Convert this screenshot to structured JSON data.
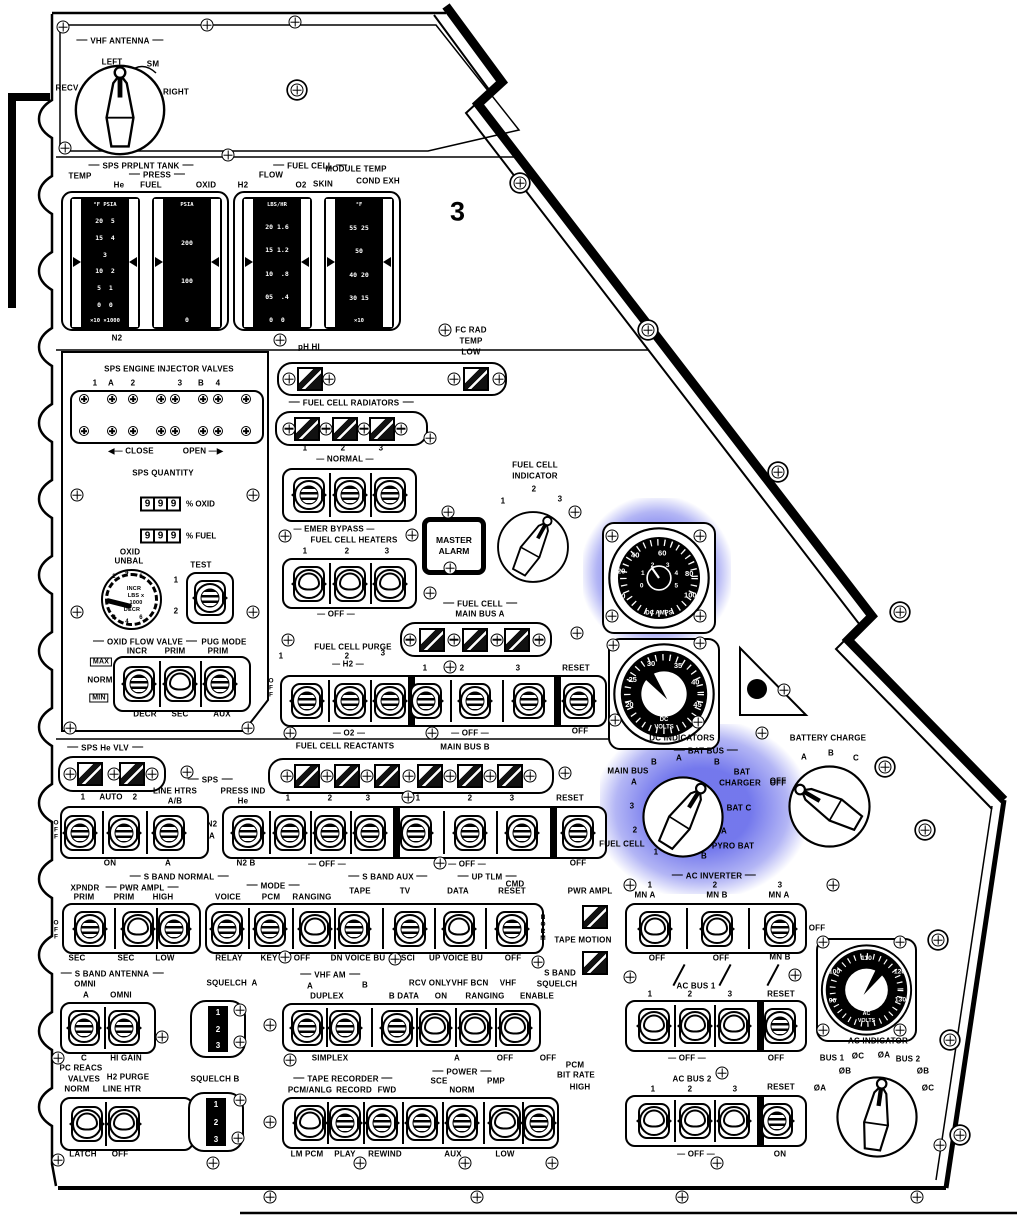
{
  "colors": {
    "highlight": "#686deb",
    "ink": "#000000",
    "paper": "#ffffff"
  },
  "panel": {
    "number": "3"
  },
  "vhf": {
    "title": "VHF ANTENNA",
    "recv": "RECV",
    "left": "LEFT",
    "sm": "SM",
    "right": "RIGHT"
  },
  "tanks": {
    "sps": "SPS PRPLNT TANK",
    "temp": "TEMP",
    "press": "PRESS",
    "he": "He",
    "fuel": "FUEL",
    "oxid": "OXID",
    "fc": "FUEL CELL",
    "flow": "FLOW",
    "h2": "H2",
    "o2": "O2",
    "module": "MODULE TEMP",
    "skin": "SKIN",
    "cond": "COND EXH",
    "n2": "N2",
    "g1h": "°F PSIA",
    "g1": [
      "20  5",
      "15  4",
      "3",
      "10  2",
      "5  1",
      "0  0"
    ],
    "g1f": "×10 ×1000",
    "g2h": "PSIA",
    "g2": [
      "200",
      "100",
      "0"
    ],
    "g3h": "LBS/HR",
    "g3": [
      "20 1.6",
      "15 1.2",
      "10  .8",
      "05  .4",
      "0  0"
    ],
    "g4h": "°F",
    "g4": [
      "55 25",
      "50",
      "40 20",
      "30 15"
    ],
    "g4f": "×10"
  },
  "caution": {
    "ph": "pH HI",
    "fc1": "FC RAD",
    "fc2": "TEMP",
    "fc3": "LOW"
  },
  "rad": {
    "title": "FUEL CELL RADIATORS",
    "n": [
      "1",
      "2",
      "3"
    ],
    "normal": "— NORMAL —",
    "emer": "— EMER BYPASS —",
    "htrs": "FUEL CELL HEATERS",
    "hn": [
      "1",
      "2",
      "3"
    ],
    "off": "— OFF —"
  },
  "ma": {
    "l1": "MASTER",
    "l2": "ALARM"
  },
  "fci": {
    "t1": "FUEL CELL",
    "t2": "INDICATOR",
    "p": [
      "1",
      "2",
      "3"
    ]
  },
  "inj": {
    "title": "SPS ENGINE INJECTOR VALVES",
    "marks": [
      "1",
      "A",
      "2",
      "3",
      "B",
      "4"
    ],
    "close": "◀— CLOSE",
    "open": "OPEN —▶"
  },
  "spsq": {
    "title": "SPS QUANTITY",
    "d": [
      "9",
      "9",
      "9"
    ],
    "oxid": "% OXID",
    "fuel": "% FUEL",
    "ou1": "OXID",
    "ou2": "UNBAL",
    "incr": "INCR",
    "lbs": "LBS x",
    "k": "1000",
    "decr": "DECR",
    "dt": [
      "2",
      "4",
      "6"
    ],
    "db": [
      "2",
      "4",
      "6"
    ],
    "test": "TEST",
    "t1": "1",
    "t2": "2"
  },
  "ofv": {
    "title": "OXID FLOW VALVE",
    "pug": "PUG MODE",
    "incr": "INCR",
    "prim": "PRIM",
    "prim2": "PRIM",
    "max": "MAX",
    "norm": "NORM",
    "min": "MIN",
    "decr": "DECR",
    "sec": "SEC",
    "aux": "AUX"
  },
  "r1": {
    "fc1": "FUEL CELL",
    "fc2": "MAIN BUS A",
    "purge": "FUEL CELL PURGE",
    "p1": "1",
    "p2": "2",
    "p3": "3",
    "h2": "— H2 —",
    "n1": "1",
    "n2": "2",
    "n3": "3",
    "reset": "RESET",
    "offv": "OFF",
    "o2": "— O2 —",
    "react": "FUEL CELL REACTANTS",
    "off1": "— OFF —",
    "mbb": "MAIN BUS B",
    "off2": "OFF"
  },
  "he": {
    "title": "SPS He VLV"
  },
  "r2": {
    "sps": "SPS",
    "lh": "LINE HTRS",
    "ab": "A/B",
    "pi": "PRESS IND",
    "hel": "He",
    "a1": "1",
    "auto": "AUTO",
    "a2": "2",
    "on": "ON",
    "a": "A",
    "n2": "N2",
    "na": "A",
    "n2b": "N2 B",
    "offv": "OFF",
    "g1": [
      "1",
      "2",
      "3"
    ],
    "g2": [
      "1",
      "2",
      "3"
    ],
    "reset": "RESET",
    "off1": "— OFF —",
    "off2": "— OFF —",
    "off3": "OFF"
  },
  "sb": {
    "title": "S BAND NORMAL",
    "xpndr": "XPNDR",
    "pa": "PWR AMPL",
    "prim1": "PRIM",
    "prim2": "PRIM",
    "high": "HIGH",
    "sec1": "SEC",
    "sec2": "SEC",
    "low": "LOW",
    "offv": "OFF",
    "mode": "MODE",
    "voice": "VOICE",
    "pcm": "PCM",
    "rng": "RANGING",
    "relay": "RELAY",
    "key": "KEY",
    "off": "OFF",
    "aux": "S BAND AUX",
    "tape": "TAPE",
    "tv": "TV",
    "dnv": "DN VOICE BU",
    "sci": "SCI",
    "uptlm": "UP TLM",
    "cmd": "CMD",
    "data": "DATA",
    "reset": "RESET",
    "upv": "UP VOICE BU",
    "off2": "OFF",
    "pa2": "PWR AMPL",
    "normv": "NORM",
    "tm": "TAPE MOTION",
    "sbs1": "S BAND",
    "sbs2": "SQUELCH"
  },
  "dca": {
    "o": [
      "0",
      "20",
      "40",
      "60",
      "80",
      "100"
    ],
    "i": [
      "0",
      "1",
      "2",
      "3",
      "4",
      "5"
    ],
    "lab": "DC AMPS"
  },
  "dcv": {
    "t": [
      "20",
      "25",
      "30",
      "35",
      "40",
      "45"
    ],
    "l1": "DC",
    "l2": "VOLTS",
    "cap": "DC INDICATORS"
  },
  "dci": {
    "bb": "BAT BUS",
    "ba": "A",
    "bbb": "B",
    "mb": "MAIN BUS",
    "mba": "A",
    "mbb": "B",
    "bat": "BAT",
    "chg": "CHARGER",
    "off": "OFF",
    "batc": "BAT C",
    "pa": "A",
    "pyro": "PYRO BAT",
    "pb": "B",
    "fc": "FUEL CELL",
    "f1": "1",
    "f2": "2",
    "f3": "3"
  },
  "bc": {
    "title": "BATTERY CHARGE",
    "a": "A",
    "b": "B",
    "c": "C",
    "off": "OFF"
  },
  "aci": {
    "title": "AC INVERTER",
    "n": [
      "1",
      "2",
      "3"
    ],
    "t": [
      "MN A",
      "MN B",
      "MN A"
    ],
    "offr": "OFF",
    "b": [
      "OFF",
      "OFF",
      "MN B"
    ],
    "bus1": "AC BUS 1",
    "bn": [
      "1",
      "2",
      "3"
    ],
    "reset": "RESET",
    "off1": "— OFF —",
    "off2": "OFF"
  },
  "acv": {
    "t": [
      "90",
      "100",
      "110",
      "120",
      "130"
    ],
    "l1": "AC",
    "l2": "VOLTS"
  },
  "acind": {
    "title": "AC INDICATOR",
    "bus1": "BUS 1",
    "bus2": "BUS 2",
    "l": [
      "ØA",
      "ØB",
      "ØC"
    ],
    "r": [
      "ØA",
      "ØB",
      "ØC"
    ]
  },
  "acb2": {
    "title": "AC BUS 2",
    "n": [
      "1",
      "2",
      "3"
    ],
    "reset": "RESET",
    "off": "— OFF —",
    "on": "ON"
  },
  "ant": {
    "title": "S BAND ANTENNA",
    "omni0": "OMNI",
    "a": "A",
    "omni": "OMNI",
    "c": "C",
    "hg": "HI GAIN"
  },
  "sqa": {
    "label": "SQUELCH  A",
    "d": [
      "1",
      "2",
      "3"
    ]
  },
  "sqb": {
    "label": "SQUELCH B",
    "d": [
      "1",
      "2",
      "3"
    ]
  },
  "vam": {
    "title": "VHF AM",
    "a": "A",
    "b": "B",
    "rcv": "RCV ONLY",
    "bcn": "VHF BCN",
    "vhf": "VHF",
    "dup": "DUPLEX",
    "bd": "B DATA",
    "on": "ON",
    "rng": "RANGING",
    "en": "ENABLE",
    "simp": "SIMPLEX",
    "a2": "A",
    "off1": "OFF",
    "off2": "OFF"
  },
  "pcr": {
    "l1": "PC REACS",
    "l2": "VALVES",
    "l3": "H2 PURGE",
    "l4": "NORM",
    "l5": "LINE HTR",
    "latch": "LATCH",
    "off": "OFF"
  },
  "tr": {
    "title": "TAPE RECORDER",
    "pcm": "PCM/ANLG",
    "rec": "RECORD",
    "fwd": "FWD",
    "pow": "POWER",
    "sce": "SCE",
    "pmp": "PMP",
    "norm": "NORM",
    "pcm2": "PCM",
    "br": "BIT RATE",
    "high": "HIGH",
    "lm": "LM PCM",
    "play": "PLAY",
    "rew": "REWIND",
    "aux": "AUX",
    "low": "LOW"
  }
}
